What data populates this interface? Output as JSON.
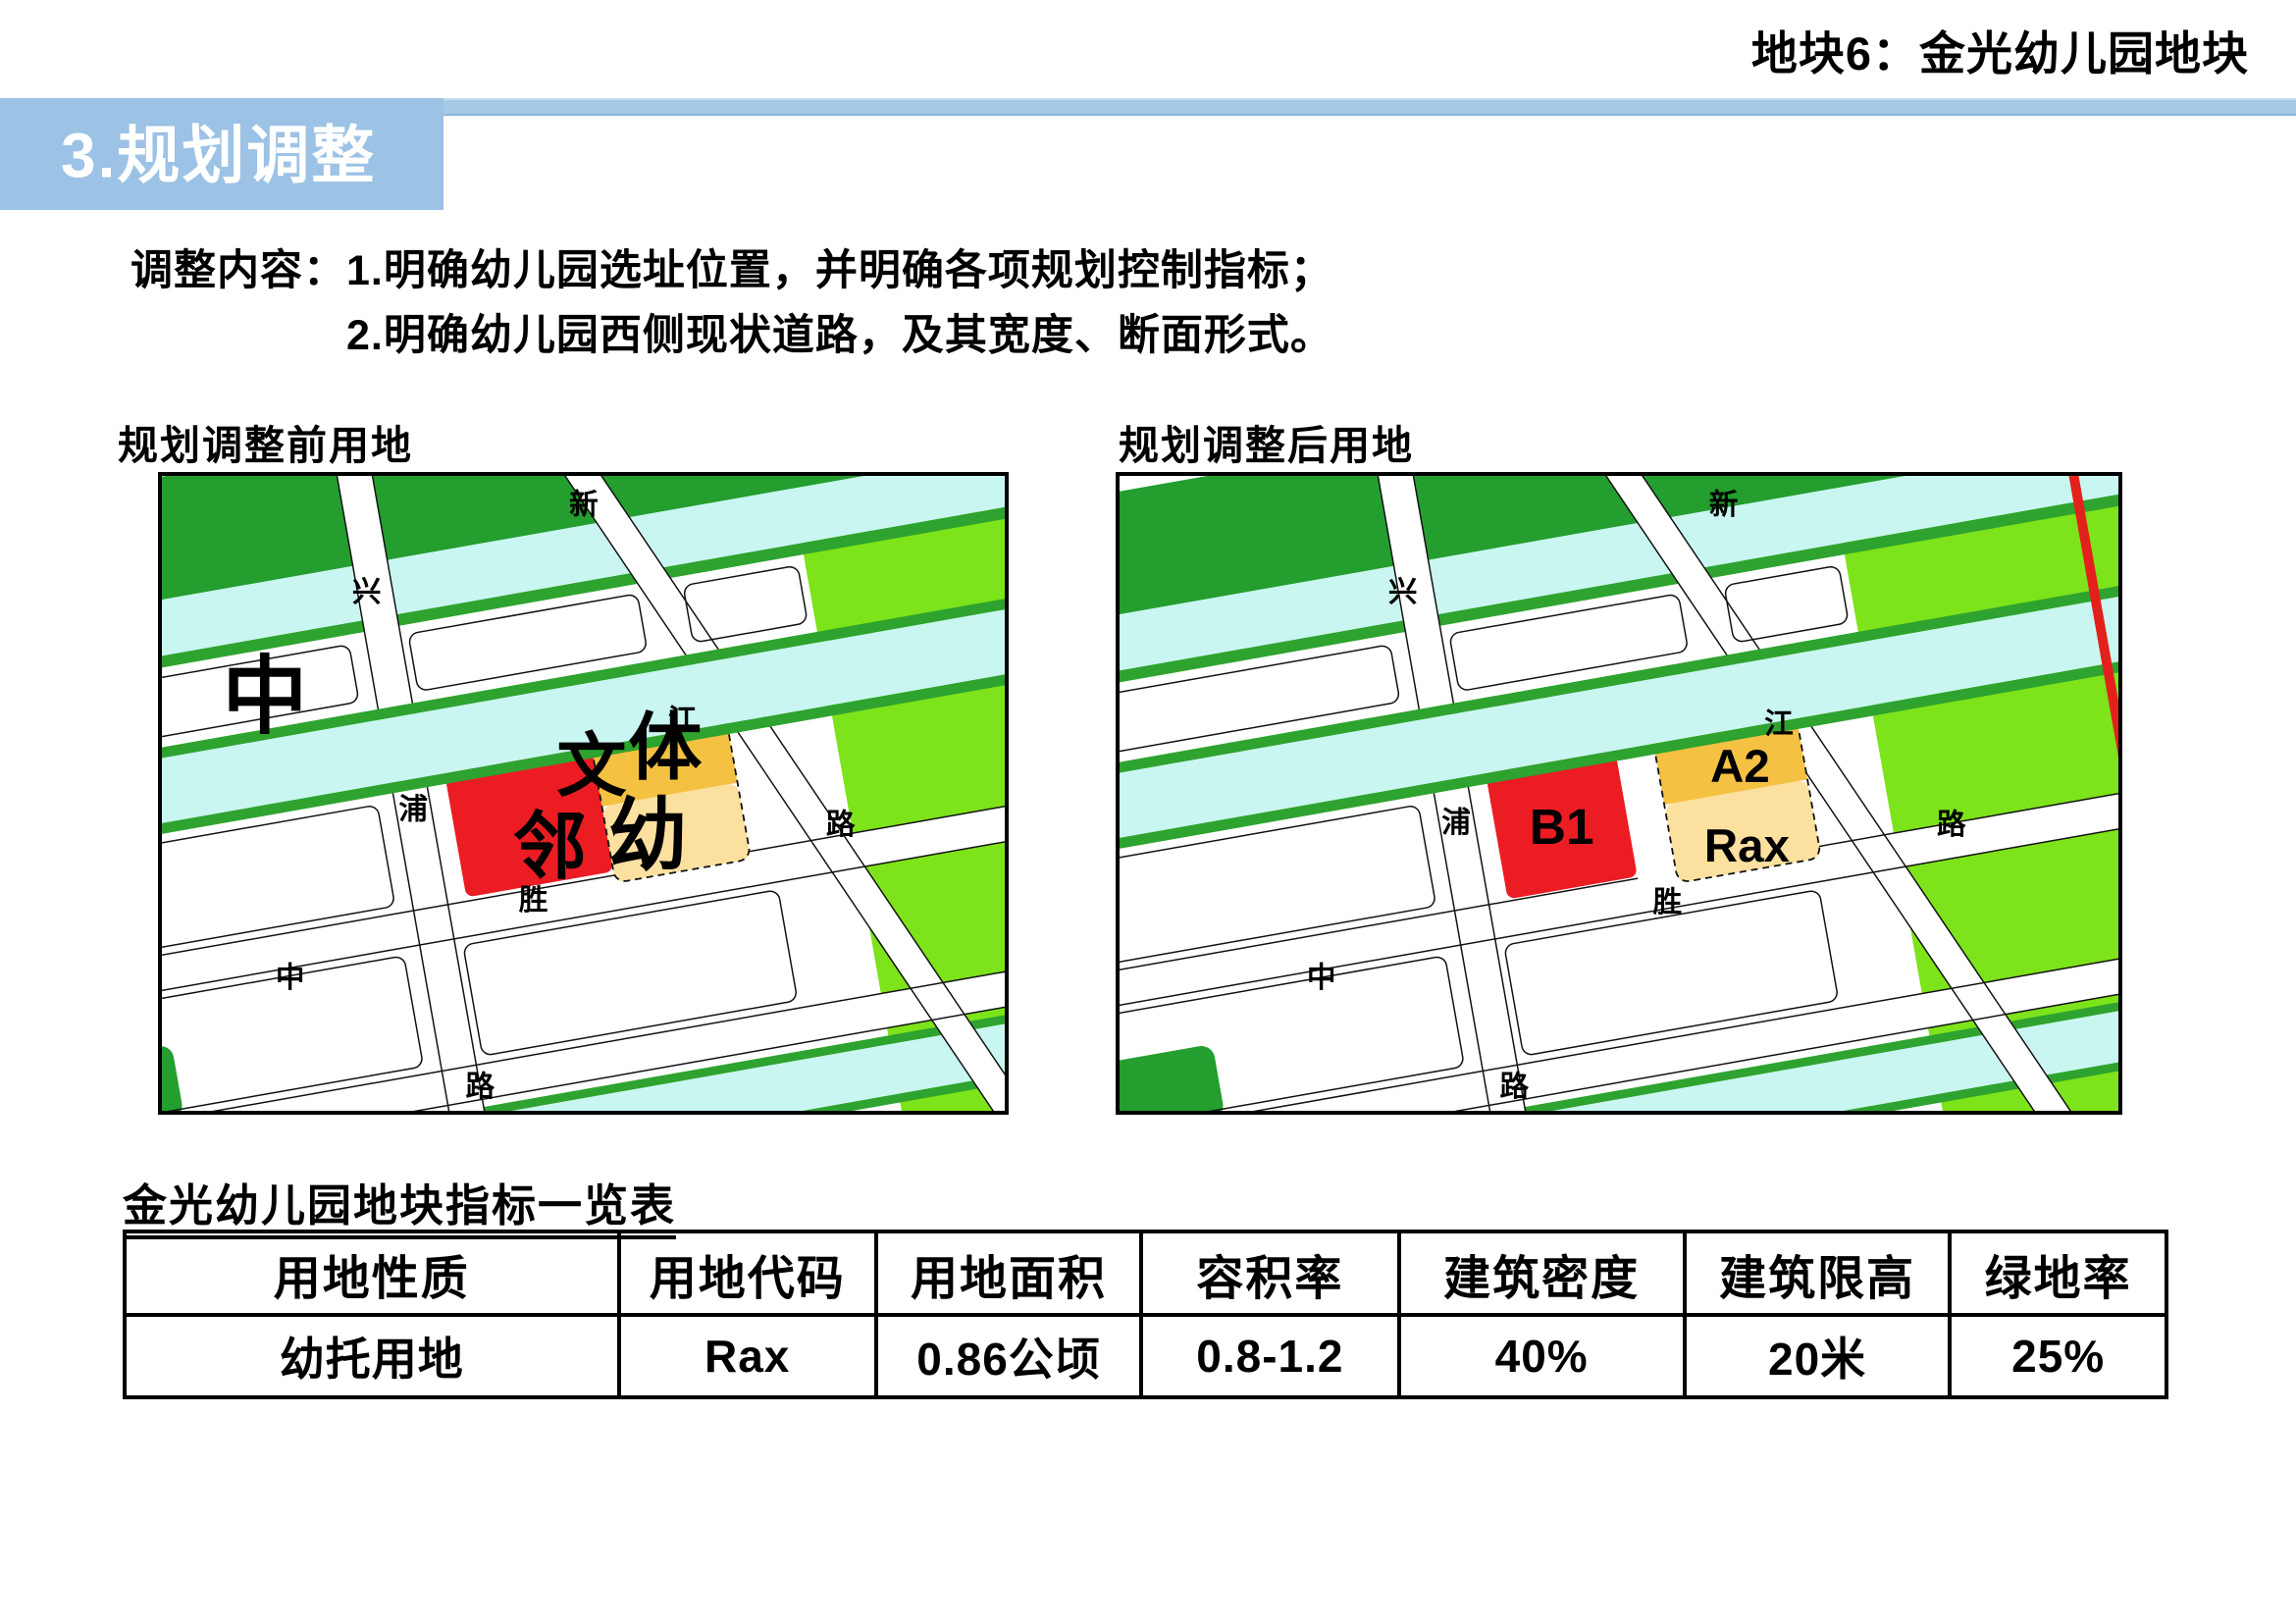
{
  "page": {
    "heading_right": "地块6：金光幼儿园地块",
    "section_title": "3.规划调整"
  },
  "adjustment": {
    "label": "调整内容：",
    "line1": "1.明确幼儿园选址位置，并明确各项规划控制指标；",
    "line2": "2.明确幼儿园西侧现状道路，及其宽度、断面形式。"
  },
  "maps": {
    "before": {
      "caption": "规划调整前用地",
      "labels": {
        "xin": "新",
        "xing": "兴",
        "jiang": "江",
        "lu_right": "路",
        "sheng": "胜",
        "zhong_road": "中",
        "lu_bottom": "路",
        "pu": "浦",
        "zhong_big": "中",
        "wen": "文",
        "ti": "体",
        "you": "幼",
        "lin": "邻"
      }
    },
    "after": {
      "caption": "规划调整后用地",
      "labels": {
        "xin": "新",
        "xing": "兴",
        "jiang": "江",
        "lu_right": "路",
        "sheng": "胜",
        "zhong_road": "中",
        "lu_bottom": "路",
        "pu": "浦",
        "b1": "B1",
        "a2": "A2",
        "rax": "Rax"
      }
    }
  },
  "table": {
    "title": "金光幼儿园地块指标一览表",
    "headers": [
      "用地性质",
      "用地代码",
      "用地面积",
      "容积率",
      "建筑密度",
      "建筑限高",
      "绿地率"
    ],
    "rows": [
      [
        "幼托用地",
        "Rax",
        "0.86公顷",
        "0.8-1.2",
        "40%",
        "20米",
        "25%"
      ]
    ]
  },
  "colors": {
    "accent_blue": "#9cc2e5",
    "strip_blue": "#a6c9e8",
    "map_dark_green": "#239e2f",
    "map_bright_green": "#7de31a",
    "map_cyan": "#c9f6f1",
    "plot_red": "#ec1c23",
    "plot_orange": "#f5c142",
    "plot_tan": "#fbe09f",
    "red_line": "#e3201b"
  }
}
